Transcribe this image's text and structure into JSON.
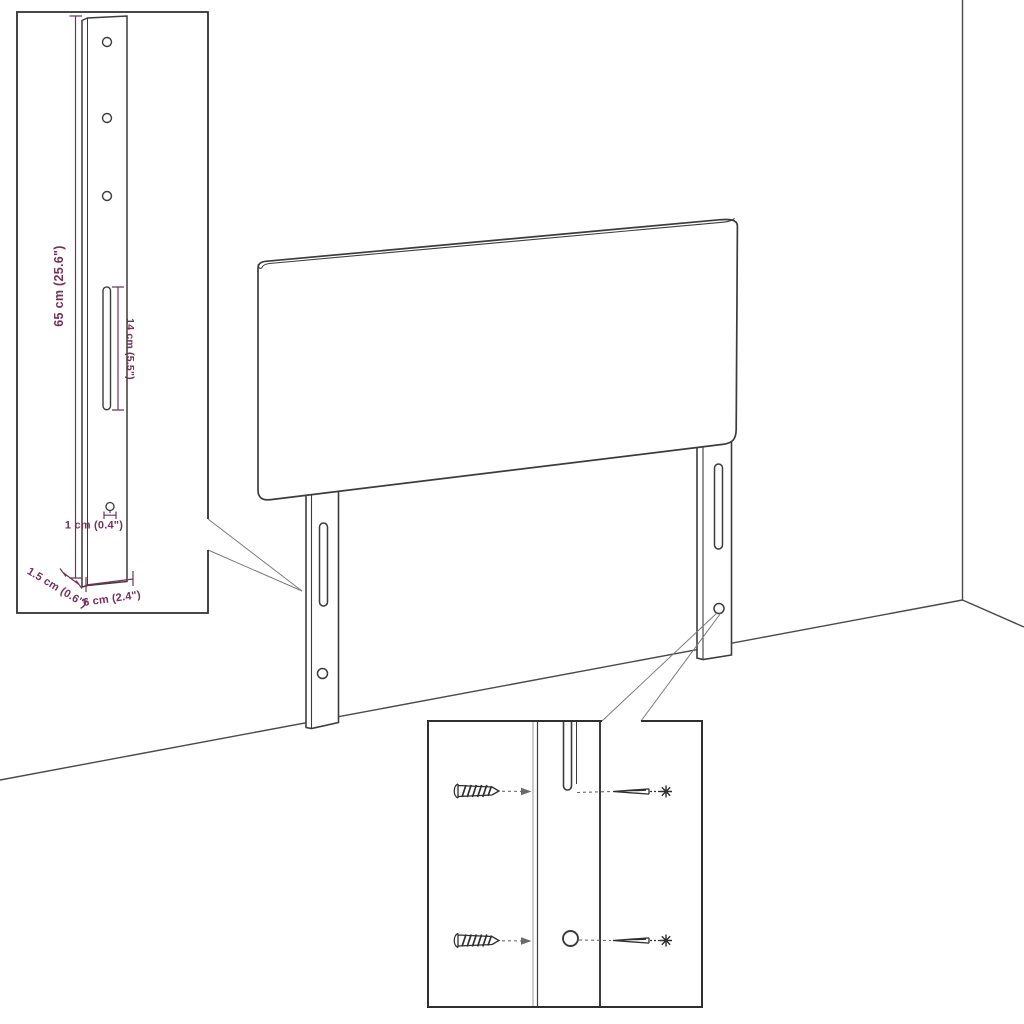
{
  "figure": {
    "kind": "product-assembly-diagram",
    "subject": "headboard with mounting brackets",
    "background_color": "#ffffff",
    "line_color": "#3c3c3c",
    "room_line_color": "#4a4a4a",
    "dimension_color": "#76305a"
  },
  "bracket_inset": {
    "dim_height": "65 cm (25.6\")",
    "dim_slot_length": "14 cm (5.5\")",
    "dim_hole": "1 cm (0.4\")",
    "dim_thickness": "1.5 cm (0.6\")",
    "dim_width": "6 cm (2.4\")",
    "hole_count": 3
  },
  "screw_inset": {
    "left_icons": [
      "screw-side-view-icon",
      "screw-side-view-icon"
    ],
    "right_icons": [
      "screw-insertion-icon",
      "screw-insertion-icon"
    ]
  }
}
